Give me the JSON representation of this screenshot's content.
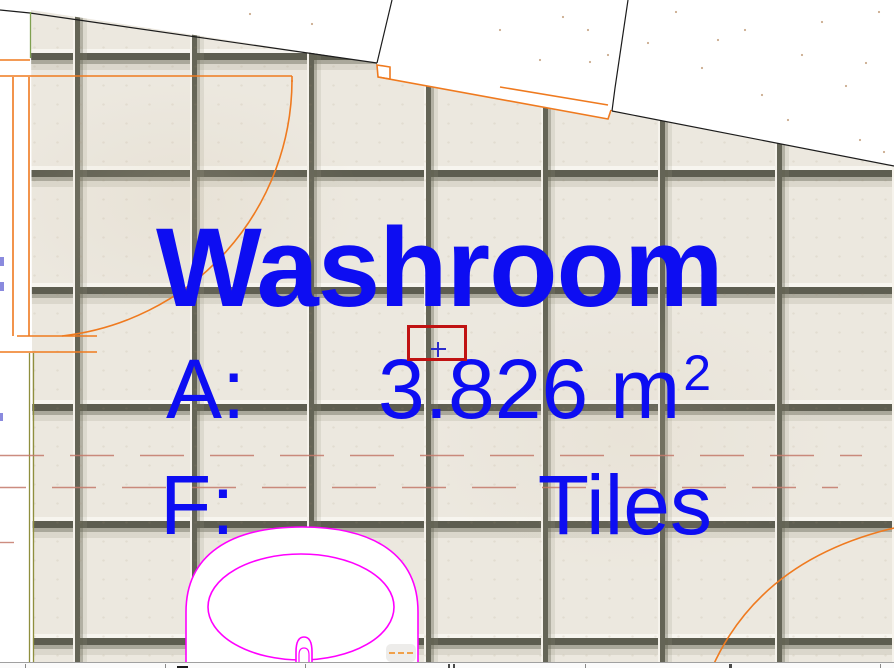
{
  "view": {
    "type": "cad-floor-plan-viewport",
    "description": "Zoomed plan view of a washroom zone with tiled floor finish"
  },
  "zone": {
    "name": "Washroom",
    "area_label": "A:",
    "area_value": "3.826",
    "area_unit_base": "m",
    "area_unit_exponent": "2",
    "floor_label": "F:",
    "floor_value": "Tiles"
  },
  "colors": {
    "zone_text": "#0d0df2",
    "selection_rect": "#c01212",
    "crosshair": "#2b2bcc",
    "door_lines": "#ef7a1f",
    "fixture_lines": "#ff00ff",
    "wall_contour": "#1c1c1c",
    "wall_edge_olive": "#8f8f3e",
    "hidden_line_red": "#c4796a",
    "tile_fill": "#ece8df",
    "tile_grout": "#5d5d50"
  }
}
